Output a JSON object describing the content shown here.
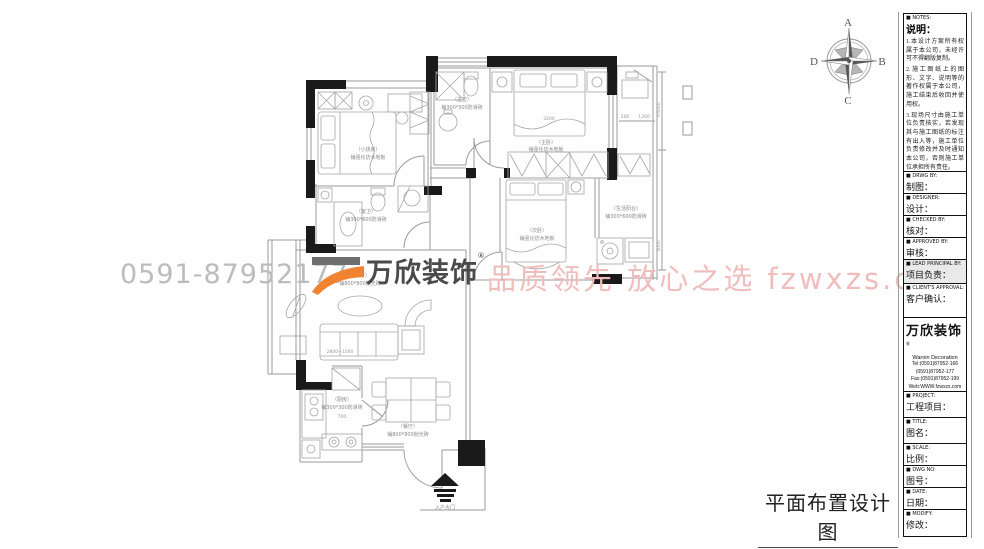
{
  "sheet": {
    "drawing_title": "平面布置设计图"
  },
  "colors": {
    "accent_orange": "#f08232",
    "watermark_pink": "#f0bdbd",
    "watermark_gray": "#bcbcbc",
    "wall_black": "#1a1a1a"
  },
  "watermark": {
    "phone": "0591-87952177",
    "logo_text": "万欣装饰",
    "reg": "®",
    "slogan": "品质领先 放心之选 fzwxzs.com"
  },
  "compass": {
    "n": "A",
    "e": "B",
    "s": "C",
    "w": "D"
  },
  "titleblock": {
    "notes": {
      "en": "■ NOTES:",
      "zh": "说明：",
      "items": [
        "1.本设计方案所有权属于本公司，未经许可不得翻版复制。",
        "2.施工图纸上的图形、文字、说明等的著作权属于本公司，施工结束后收回并使用权。",
        "3.现场尺寸由施工单位负责核实，若发现其与施工图纸的标注有出入等，施工单位负责修改并及时通知本公司，否则施工单位承担所有责任。",
        "4.本设计方案是按客户要求设计，经客户签字确认为设计定本，不得随意更改。"
      ]
    },
    "fields": [
      {
        "en": "■ DRWG BY:",
        "zh": "制图："
      },
      {
        "en": "■ DESIGNER:",
        "zh": "设计："
      },
      {
        "en": "■ CHECKED BY:",
        "zh": "核对："
      },
      {
        "en": "■ APPROVED BY:",
        "zh": "审核："
      },
      {
        "en": "■ LEAD PRINCIPAL BY:",
        "zh": "项目负责："
      },
      {
        "en": "■ CLIENT'S APPROVAL:",
        "zh": "客户确认："
      }
    ],
    "company": {
      "name": "万欣装饰",
      "reg": "®",
      "en": "Waroin Decoration",
      "tel1": "Tel:(0591)87952-166",
      "tel2": "(0591)87952-177",
      "fax": "Fax:(0591)87952-199",
      "web": "Web:WWW.fzwxzs.com"
    },
    "fields2": [
      {
        "en": "■ PROJECT:",
        "zh": "工程项目："
      },
      {
        "en": "■ TITLE:",
        "zh": "图名："
      },
      {
        "en": "■ SCALE:",
        "zh": "比例："
      },
      {
        "en": "■ DWG NO:",
        "zh": "图号："
      },
      {
        "en": "■ DATE:",
        "zh": "日期："
      },
      {
        "en": "■ MODIFY:",
        "zh": "修改："
      }
    ]
  },
  "plan": {
    "rooms": [
      {
        "name": "（小孩房）",
        "floor": "铺强化仿木地板"
      },
      {
        "name": "（主卫）",
        "floor": "铺300*300防滑砖"
      },
      {
        "name": "（主卧）",
        "floor": "铺强化仿木地板"
      },
      {
        "name": "（次卧）",
        "floor": "铺强化仿木地板"
      },
      {
        "name": "（生活阳台）",
        "floor": "铺300*600防滑砖"
      },
      {
        "name": "（客卫）",
        "floor": "铺300*600防滑砖"
      },
      {
        "name": "（客厅）",
        "floor": "铺800*800抛光砖"
      },
      {
        "name": "（厨房）",
        "floor": "铺300*300防滑砖"
      },
      {
        "name": "（餐厅）",
        "floor": "铺800*800抛光砖"
      }
    ],
    "dims": {
      "sofa": "2800+1000",
      "master_bed": "3200",
      "w200": "200",
      "w1260": "1260",
      "v5000a": "≈5000",
      "v5000b": "5000",
      "k700": "700"
    },
    "entry_label": "入户大门"
  }
}
